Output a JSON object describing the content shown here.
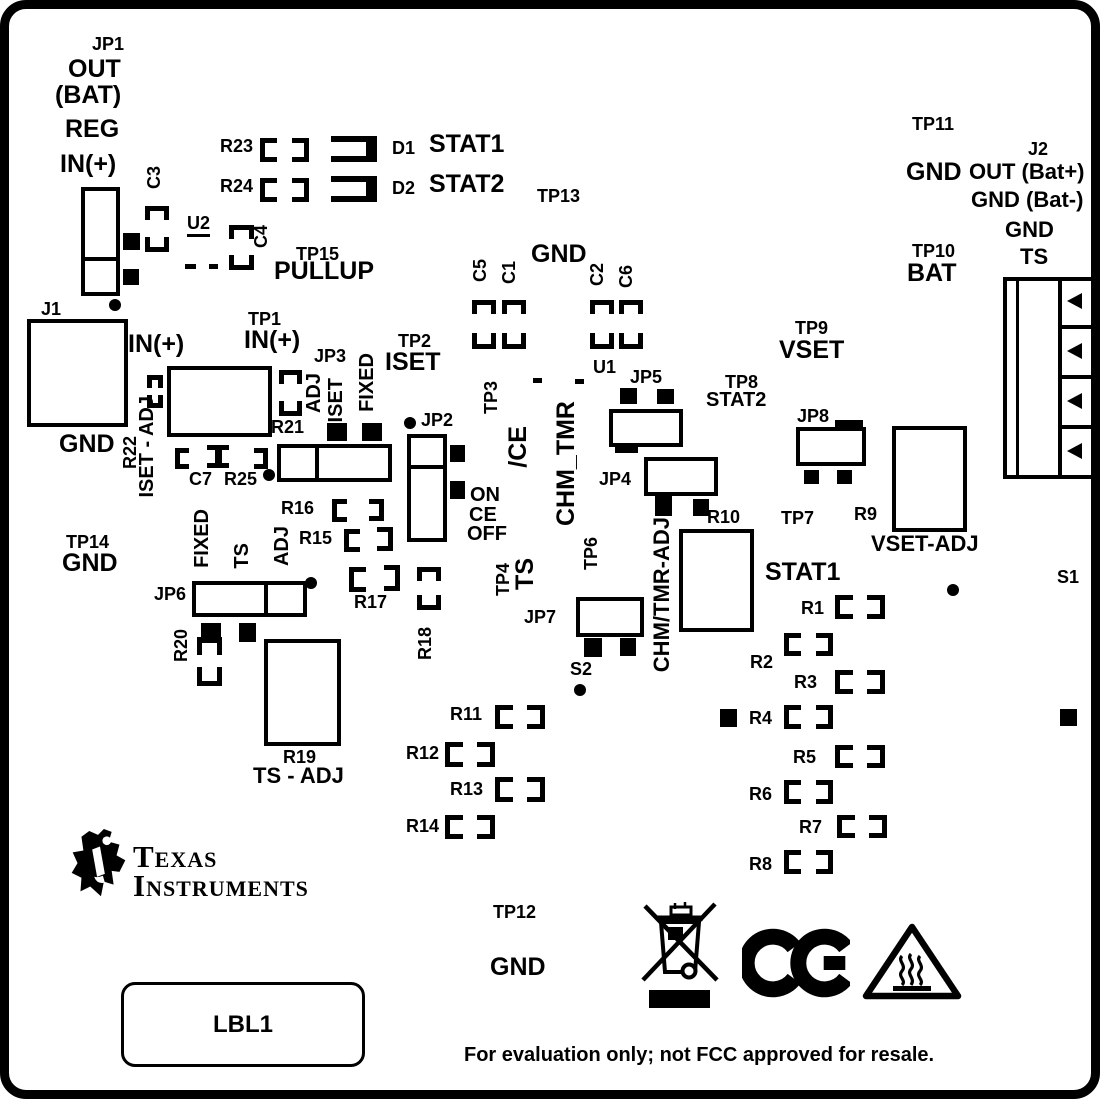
{
  "colors": {
    "silkscreen": "#000000",
    "background": "#ffffff"
  },
  "icons": {
    "ti_logo": "texas-instruments-logo",
    "weee": "weee-crossed-wheeled-bin",
    "ce": "ce-mark",
    "hot_surface": "hot-surface-warning-triangle"
  },
  "labels": {
    "jp1": "JP1",
    "jp1_out": "OUT",
    "jp1_bat": "(BAT)",
    "jp1_reg": "REG",
    "jp1_in": "IN(+)",
    "c3": "C3",
    "u2": "U2",
    "c4": "C4",
    "tp15": "TP15",
    "pullup": "PULLUP",
    "r23": "R23",
    "r24": "R24",
    "d1": "D1",
    "d1_name": "STAT1",
    "d2": "D2",
    "d2_name": "STAT2",
    "tp13": "TP13",
    "tp13_gnd": "GND",
    "c5": "C5",
    "c1": "C1",
    "c2": "C2",
    "c6": "C6",
    "tp11": "TP11",
    "tp11_gnd": "GND",
    "j2": "J2",
    "j2_out": "OUT (Bat+)",
    "j2_gnd1": "GND (Bat-)",
    "j2_gnd2": "GND",
    "j2_ts": "TS",
    "tp10": "TP10",
    "tp10_bat": "BAT",
    "j1": "J1",
    "j1_gnd": "GND",
    "j1_in": "IN(+)",
    "tp1": "TP1",
    "tp1_in": "IN(+)",
    "r22": "R22",
    "iset_adj": "ISET - ADJ",
    "c7": "C7",
    "r25": "R25",
    "r21": "R21",
    "jp3": "JP3",
    "jp3_adj": "ADJ",
    "jp3_iset": "ISET",
    "jp3_fixed": "FIXED",
    "tp2": "TP2",
    "tp2_iset": "ISET",
    "jp2": "JP2",
    "jp2_on": "ON",
    "jp2_ce": "CE",
    "jp2_off": "OFF",
    "tp3": "TP3",
    "ce_n": "/CE",
    "chm_tmr": "CHM_TMR",
    "u1": "U1",
    "jp5": "JP5",
    "jp4": "JP4",
    "r10": "R10",
    "chm_tmr_adj": "CHM/TMR-ADJ",
    "tp8": "TP8",
    "tp8_stat2": "STAT2",
    "tp9": "TP9",
    "tp9_vset": "VSET",
    "jp8": "JP8",
    "r9": "R9",
    "vset_adj": "VSET-ADJ",
    "tp7": "TP7",
    "stat1": "STAT1",
    "s1": "S1",
    "tp14": "TP14",
    "tp14_gnd": "GND",
    "jp6": "JP6",
    "jp6_fixed": "FIXED",
    "jp6_ts": "TS",
    "jp6_adj": "ADJ",
    "r20": "R20",
    "r19": "R19",
    "ts_adj": "TS - ADJ",
    "r15": "R15",
    "r16": "R16",
    "r17": "R17",
    "r18": "R18",
    "tp4": "TP4",
    "tp4_ts": "TS",
    "tp6": "TP6",
    "jp7": "JP7",
    "s2": "S2",
    "r11": "R11",
    "r12": "R12",
    "r13": "R13",
    "r14": "R14",
    "r1": "R1",
    "r2": "R2",
    "r3": "R3",
    "r4": "R4",
    "r5": "R5",
    "r6": "R6",
    "r7": "R7",
    "r8": "R8",
    "tp12": "TP12",
    "tp12_gnd": "GND",
    "lbl1": "LBL1",
    "footer": "For evaluation only; not FCC approved for resale.",
    "logo_texas": "Texas",
    "logo_instruments": "Instruments"
  }
}
